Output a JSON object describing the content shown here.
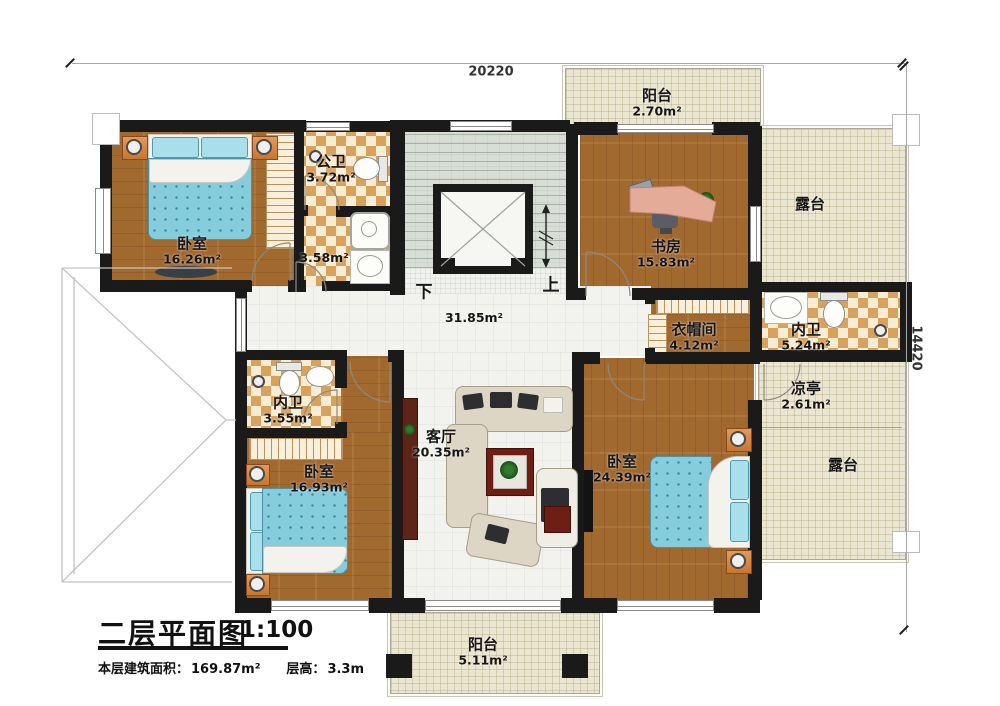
{
  "colors": {
    "wall": "#1a1a1a",
    "wood": "#a2692f",
    "checker_dark": "#d9a25c",
    "checker_light": "#f7edd4",
    "terrace": "#ebe6d0",
    "hall": "#f2f2ef",
    "stair": "#d8ded6",
    "accent_bed": "#85ccdc",
    "sofa": "#ddd6c4",
    "table_red": "#6f1e14",
    "cabinet": "#5c2517"
  },
  "dimensions": {
    "top": "20220",
    "right": "14420"
  },
  "stair": {
    "down": "下",
    "up": "上"
  },
  "rooms": {
    "bedroom_nw": {
      "name": "卧室",
      "area": "16.26m²"
    },
    "public_bath": {
      "name": "公卫",
      "area": "3.72m²"
    },
    "shower_room": {
      "area": "3.58m²"
    },
    "balcony_top": {
      "name": "阳台",
      "area": "2.70m²"
    },
    "study": {
      "name": "书房",
      "area": "15.83m²"
    },
    "terrace_ne": {
      "name": "露台"
    },
    "closet": {
      "name": "衣帽间",
      "area": "4.12m²"
    },
    "bath_e": {
      "name": "内卫",
      "area": "5.24m²"
    },
    "pavilion": {
      "name": "凉亭",
      "area": "2.61m²"
    },
    "terrace_se": {
      "name": "露台"
    },
    "hallway": {
      "area": "31.85m²"
    },
    "bath_w": {
      "name": "内卫",
      "area": "3.55m²"
    },
    "bedroom_sw": {
      "name": "卧室",
      "area": "16.93m²"
    },
    "living": {
      "name": "客厅",
      "area": "20.35m²"
    },
    "bedroom_se": {
      "name": "卧室",
      "area": "24.39m²"
    },
    "balcony_bottom": {
      "name": "阳台",
      "area": "5.11m²"
    }
  },
  "title_block": {
    "title": "二层平面图",
    "scale": "1:100",
    "area_label": "本层建筑面积：",
    "area_value": "169.87m²",
    "height_label": "层高：",
    "height_value": "3.3m"
  }
}
